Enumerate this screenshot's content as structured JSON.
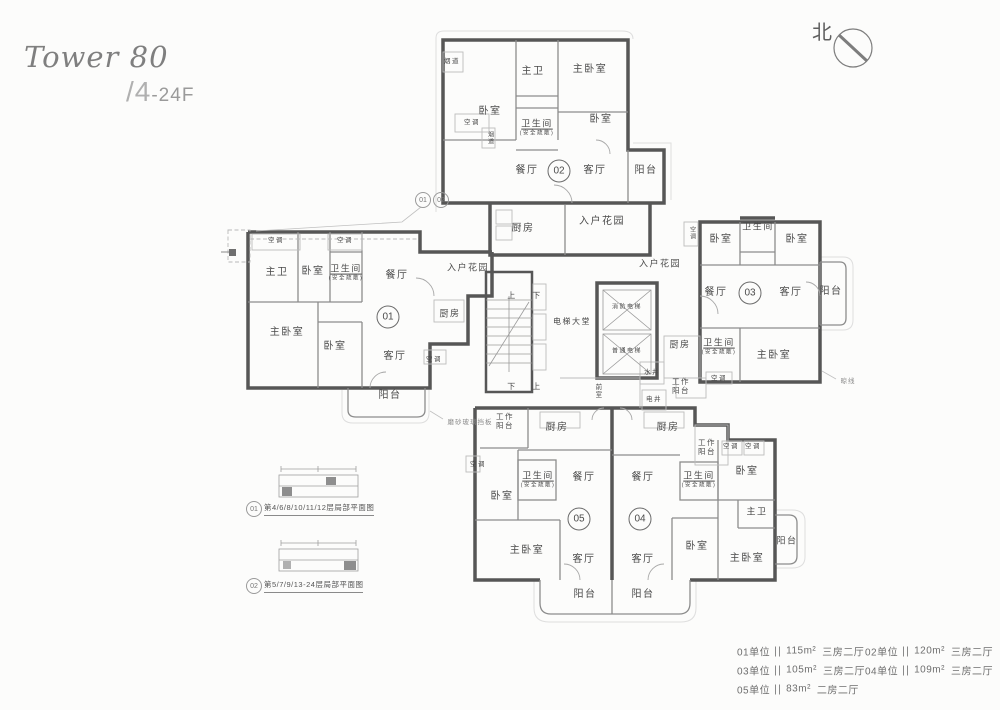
{
  "header": {
    "title": "Tower 80",
    "floors": "/4-24F",
    "north": "北"
  },
  "colors": {
    "wall": "#565656",
    "partition": "#8c8c8c",
    "light_line": "#bcbcbc",
    "label_text": "#4a4a4a"
  },
  "plan": {
    "rooms": [
      {
        "t": "烟道",
        "x": 452,
        "y": 62,
        "s": 6.5
      },
      {
        "t": "卧室",
        "x": 490,
        "y": 112
      },
      {
        "t": "主卫",
        "x": 533,
        "y": 72
      },
      {
        "t": "主卧室",
        "x": 590,
        "y": 70
      },
      {
        "t": "卧室",
        "x": 601,
        "y": 120
      },
      {
        "t": "空调",
        "x": 472,
        "y": 123,
        "s": 6.5
      },
      {
        "t": "烟道",
        "x": 489,
        "y": 138,
        "s": 6,
        "v": true
      },
      {
        "t": "卫生间",
        "x": 537,
        "y": 124,
        "s": 9,
        "u": true
      },
      {
        "t": "(安全疏散)",
        "x": 537,
        "y": 134,
        "s": 5.5
      },
      {
        "t": "餐厅",
        "x": 527,
        "y": 171
      },
      {
        "t": "客厅",
        "x": 595,
        "y": 171
      },
      {
        "t": "阳台",
        "x": 646,
        "y": 171
      },
      {
        "t": "厨房",
        "x": 523,
        "y": 229
      },
      {
        "t": "入户花园",
        "x": 602,
        "y": 222
      },
      {
        "t": "入户花园",
        "x": 468,
        "y": 268,
        "s": 9
      },
      {
        "t": "入户花园",
        "x": 660,
        "y": 264,
        "s": 9
      },
      {
        "t": "上",
        "x": 512,
        "y": 296,
        "s": 8
      },
      {
        "t": "下",
        "x": 537,
        "y": 296,
        "s": 8
      },
      {
        "t": "下",
        "x": 512,
        "y": 387,
        "s": 8
      },
      {
        "t": "上",
        "x": 537,
        "y": 387,
        "s": 8
      },
      {
        "t": "电梯大堂",
        "x": 572,
        "y": 322,
        "s": 8
      },
      {
        "t": "消防电梯",
        "x": 627,
        "y": 308,
        "s": 6
      },
      {
        "t": "普通电梯",
        "x": 627,
        "y": 352,
        "s": 6
      },
      {
        "t": "前室",
        "x": 597,
        "y": 391,
        "s": 6.5,
        "v": true
      },
      {
        "t": "水井",
        "x": 652,
        "y": 373,
        "s": 6.5
      },
      {
        "t": "电井",
        "x": 654,
        "y": 400,
        "s": 6.5
      },
      {
        "t": "工作\n阳台",
        "x": 681,
        "y": 386,
        "s": 7.5
      },
      {
        "t": "厨房",
        "x": 680,
        "y": 345,
        "s": 9
      },
      {
        "t": "空调",
        "x": 719,
        "y": 379,
        "s": 6.5
      },
      {
        "t": "空调",
        "x": 276,
        "y": 241,
        "s": 6.5
      },
      {
        "t": "空调",
        "x": 345,
        "y": 241,
        "s": 6.5
      },
      {
        "t": "主卫",
        "x": 277,
        "y": 273
      },
      {
        "t": "卧室",
        "x": 313,
        "y": 272
      },
      {
        "t": "卫生间",
        "x": 346,
        "y": 269,
        "s": 9,
        "u": true
      },
      {
        "t": "(安全疏散)",
        "x": 346,
        "y": 279,
        "s": 5.5
      },
      {
        "t": "餐厅",
        "x": 397,
        "y": 276
      },
      {
        "t": "厨房",
        "x": 450,
        "y": 314,
        "s": 9
      },
      {
        "t": "主卧室",
        "x": 287,
        "y": 333
      },
      {
        "t": "卧室",
        "x": 335,
        "y": 347
      },
      {
        "t": "客厅",
        "x": 395,
        "y": 357
      },
      {
        "t": "空调",
        "x": 434,
        "y": 360,
        "s": 6.5
      },
      {
        "t": "阳台",
        "x": 390,
        "y": 396
      },
      {
        "t": "空调",
        "x": 691,
        "y": 233,
        "s": 6,
        "v": true
      },
      {
        "t": "卧室",
        "x": 721,
        "y": 240
      },
      {
        "t": "卫生间",
        "x": 758,
        "y": 227,
        "s": 9
      },
      {
        "t": "卧室",
        "x": 797,
        "y": 240
      },
      {
        "t": "餐厅",
        "x": 716,
        "y": 293
      },
      {
        "t": "客厅",
        "x": 791,
        "y": 293
      },
      {
        "t": "阳台",
        "x": 831,
        "y": 292
      },
      {
        "t": "卫生间",
        "x": 719,
        "y": 343,
        "s": 9,
        "u": true
      },
      {
        "t": "(安全疏散)",
        "x": 719,
        "y": 353,
        "s": 5.5
      },
      {
        "t": "主卧室",
        "x": 774,
        "y": 356
      },
      {
        "t": "工作\n阳台",
        "x": 505,
        "y": 421,
        "s": 7.5
      },
      {
        "t": "厨房",
        "x": 557,
        "y": 428
      },
      {
        "t": "空调",
        "x": 478,
        "y": 465,
        "s": 6.5
      },
      {
        "t": "卫生间",
        "x": 538,
        "y": 476,
        "s": 9,
        "u": true
      },
      {
        "t": "(安全疏散)",
        "x": 538,
        "y": 486,
        "s": 5.5
      },
      {
        "t": "卧室",
        "x": 502,
        "y": 497
      },
      {
        "t": "餐厅",
        "x": 584,
        "y": 478
      },
      {
        "t": "主卧室",
        "x": 527,
        "y": 551
      },
      {
        "t": "客厅",
        "x": 584,
        "y": 560
      },
      {
        "t": "阳台",
        "x": 585,
        "y": 595
      },
      {
        "t": "厨房",
        "x": 668,
        "y": 428
      },
      {
        "t": "工作\n阳台",
        "x": 707,
        "y": 447,
        "s": 7.5
      },
      {
        "t": "餐厅",
        "x": 643,
        "y": 478
      },
      {
        "t": "卫生间",
        "x": 699,
        "y": 476,
        "s": 9,
        "u": true
      },
      {
        "t": "(安全疏散)",
        "x": 699,
        "y": 486,
        "s": 5.5
      },
      {
        "t": "空调",
        "x": 731,
        "y": 447,
        "s": 6.5
      },
      {
        "t": "空调",
        "x": 753,
        "y": 447,
        "s": 6.5
      },
      {
        "t": "卧室",
        "x": 747,
        "y": 472
      },
      {
        "t": "主卫",
        "x": 757,
        "y": 512,
        "s": 9
      },
      {
        "t": "卧室",
        "x": 697,
        "y": 547
      },
      {
        "t": "主卧室",
        "x": 747,
        "y": 559
      },
      {
        "t": "阳台",
        "x": 787,
        "y": 541,
        "s": 9
      },
      {
        "t": "客厅",
        "x": 643,
        "y": 560
      },
      {
        "t": "阳台",
        "x": 643,
        "y": 595
      }
    ],
    "unit_markers": [
      {
        "num": "01",
        "x": 388,
        "y": 317
      },
      {
        "num": "02",
        "x": 559,
        "y": 171
      },
      {
        "num": "03",
        "x": 750,
        "y": 293
      },
      {
        "num": "04",
        "x": 640,
        "y": 519
      },
      {
        "num": "05",
        "x": 579,
        "y": 519
      }
    ],
    "callout_markers": [
      {
        "num": "01",
        "x": 423,
        "y": 200
      },
      {
        "num": "02",
        "x": 441,
        "y": 200
      }
    ],
    "notes": [
      {
        "t": "磨砂玻璃挡板",
        "x": 470,
        "y": 421
      },
      {
        "t": "晾线",
        "x": 848,
        "y": 380
      }
    ],
    "insets": [
      {
        "num": "01",
        "label": "第4/6/8/10/11/12层局部平面图",
        "cx": 254,
        "cy": 509,
        "tx": 264,
        "ty": 509
      },
      {
        "num": "02",
        "label": "第5/7/9/13-24层局部平面图",
        "cx": 254,
        "cy": 586,
        "tx": 264,
        "ty": 586
      }
    ]
  },
  "legend": {
    "items": [
      {
        "unit": "01单位",
        "area": "115m²",
        "layout": "三房二厅",
        "x": 737,
        "y": 651
      },
      {
        "unit": "02单位",
        "area": "120m²",
        "layout": "三房二厅",
        "x": 865,
        "y": 651
      },
      {
        "unit": "03单位",
        "area": "105m²",
        "layout": "三房二厅",
        "x": 737,
        "y": 670
      },
      {
        "unit": "04单位",
        "area": "109m²",
        "layout": "三房二厅",
        "x": 865,
        "y": 670
      },
      {
        "unit": "05单位",
        "area": "83m²",
        "layout": "二房二厅",
        "x": 737,
        "y": 689
      }
    ]
  }
}
